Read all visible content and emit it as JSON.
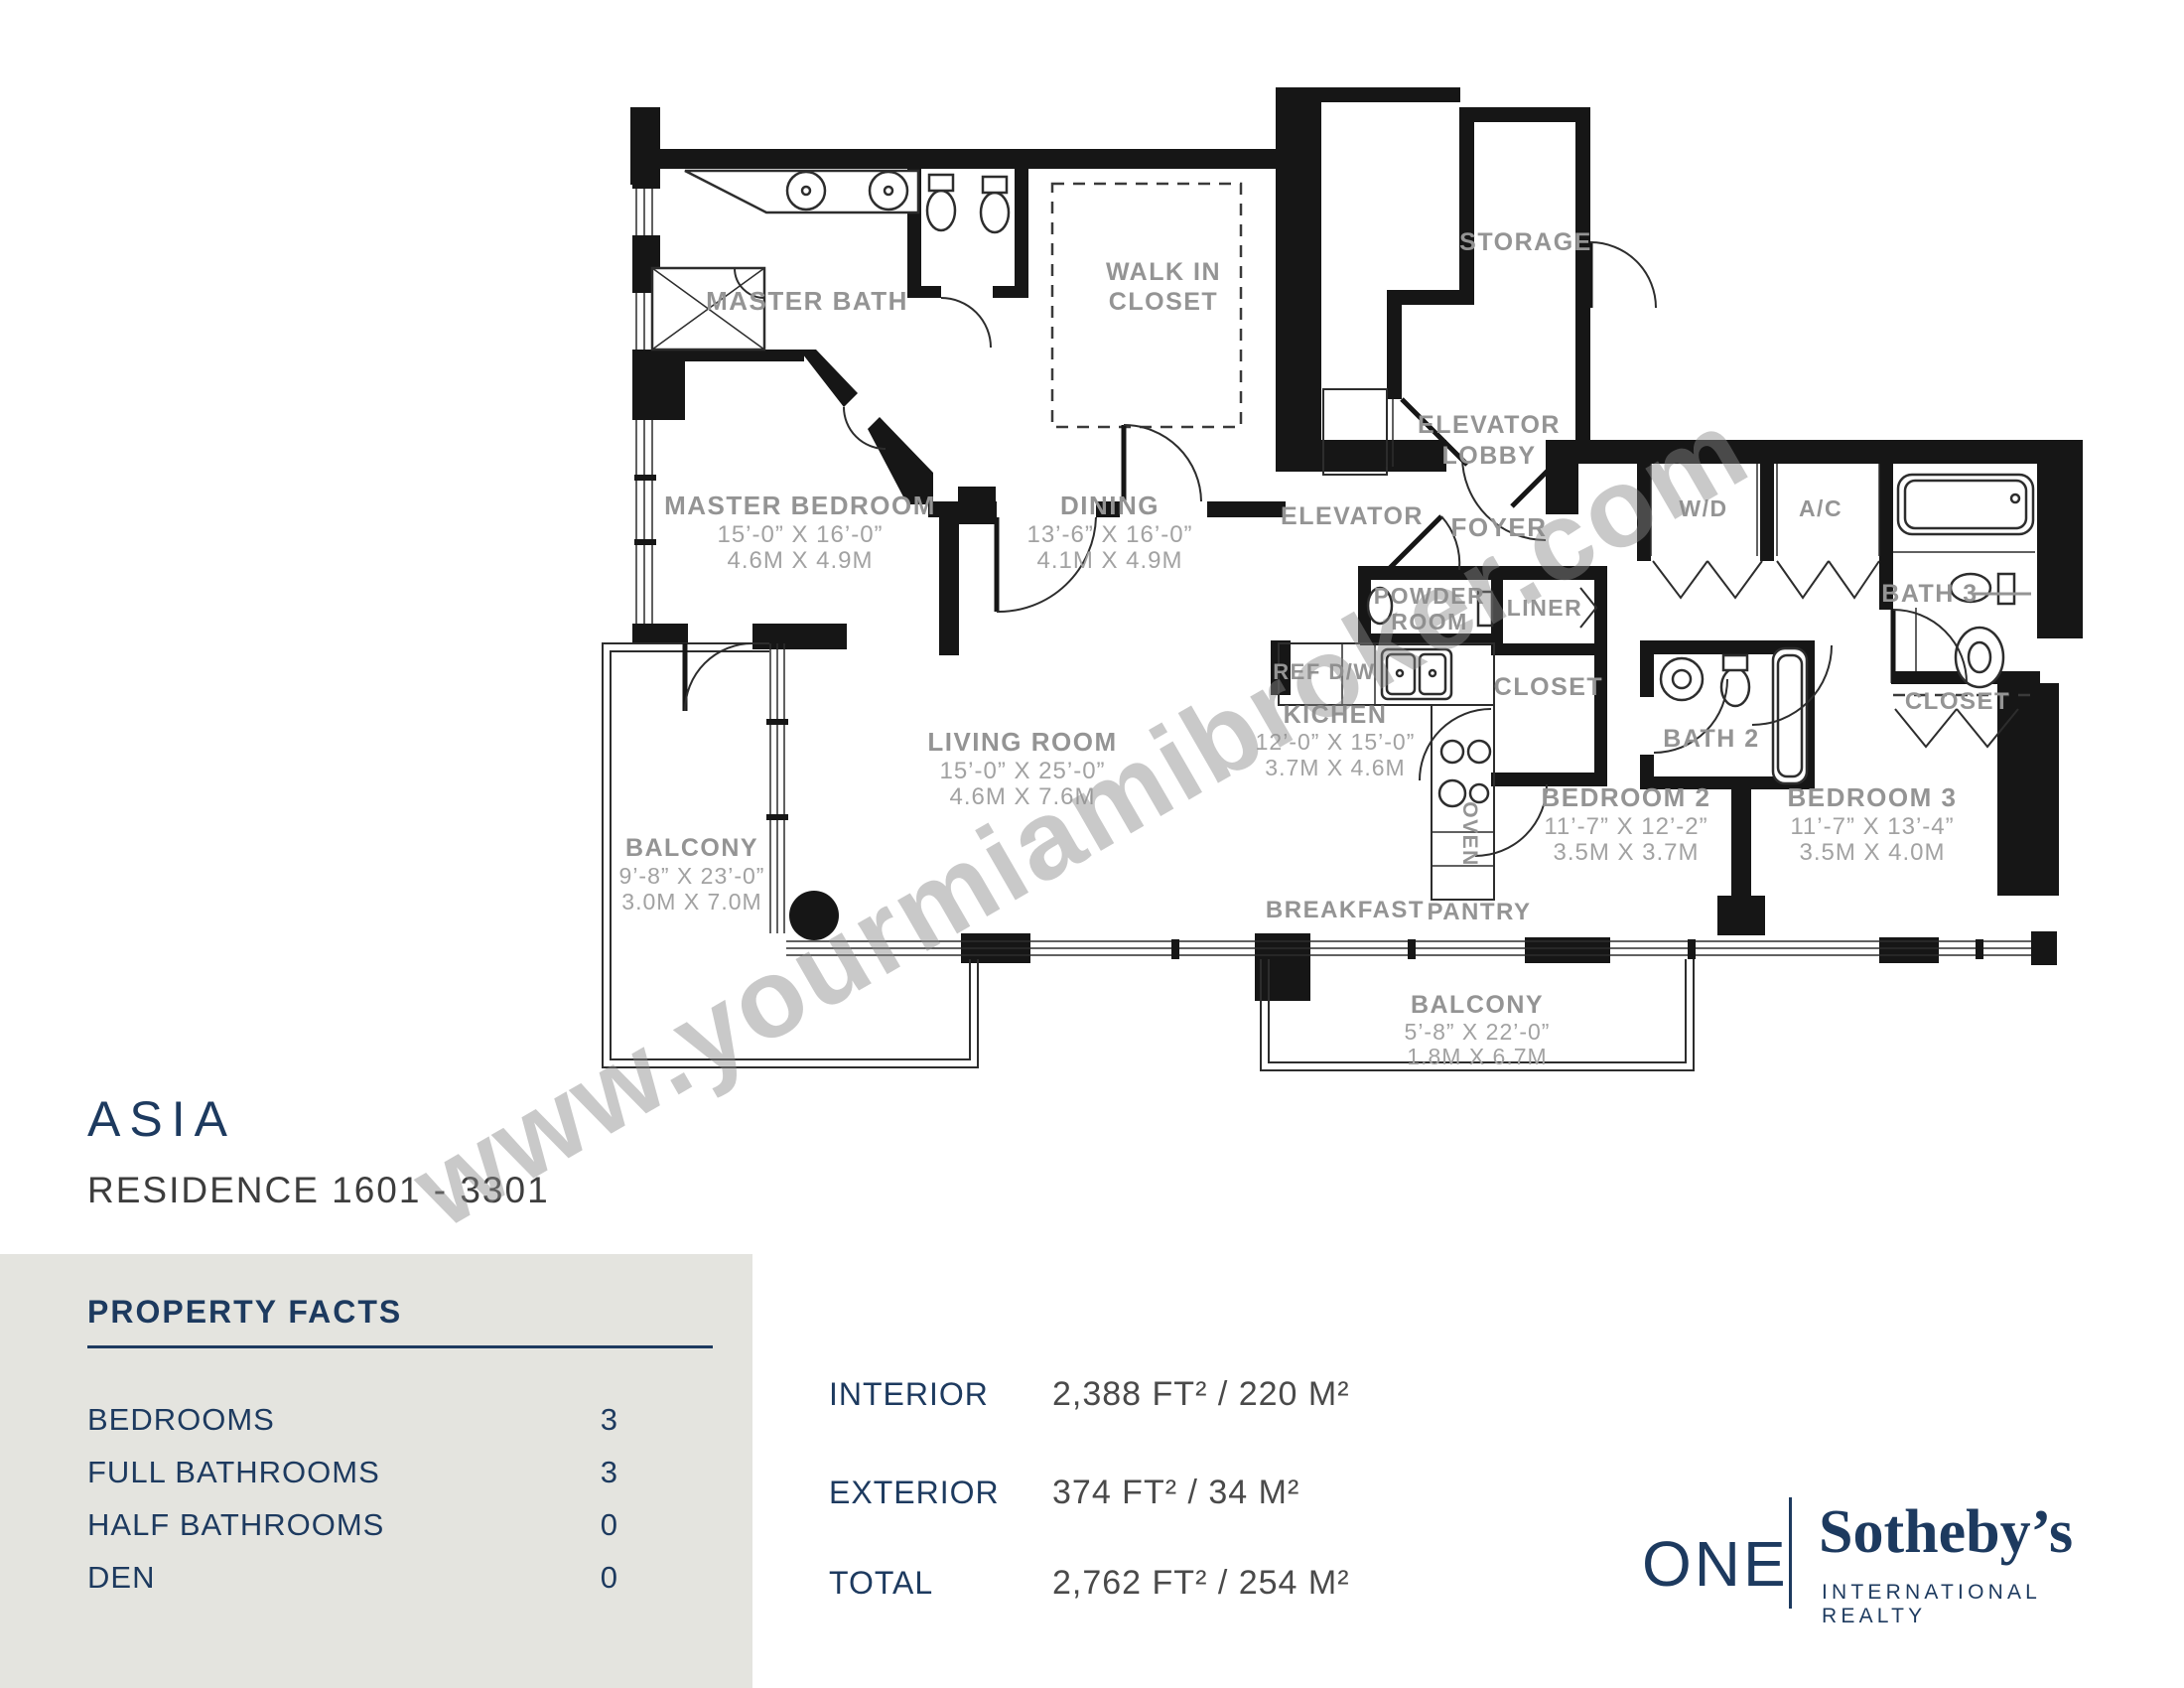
{
  "colors": {
    "accent_navy": "#1d3a5f",
    "wall_black": "#161616",
    "room_label_gray": "#949494",
    "panel_bg": "#e4e4df"
  },
  "watermark": "www.yourmiamibroker.com",
  "title": {
    "building": "ASIA",
    "residence": "RESIDENCE 1601 - 3301"
  },
  "property_facts": {
    "heading": "PROPERTY FACTS",
    "rows": [
      {
        "label": "BEDROOMS",
        "value": "3"
      },
      {
        "label": "FULL BATHROOMS",
        "value": "3"
      },
      {
        "label": "HALF BATHROOMS",
        "value": "0"
      },
      {
        "label": "DEN",
        "value": "0"
      }
    ]
  },
  "areas": [
    {
      "label": "INTERIOR",
      "value": "2,388 FT²  / 220 M²"
    },
    {
      "label": "EXTERIOR",
      "value": "374 FT²  / 34 M²"
    },
    {
      "label": "TOTAL",
      "value": "2,762 FT²  / 254 M²"
    }
  ],
  "logo": {
    "one": "ONE",
    "brand": "Sotheby’s",
    "sub": "INTERNATIONAL REALTY"
  },
  "plan": {
    "master_bath": {
      "name": "MASTER BATH"
    },
    "walk_in_closet": {
      "l1": "WALK IN",
      "l2": "CLOSET"
    },
    "storage": {
      "name": "STORAGE"
    },
    "elevator_lobby": {
      "l1": "ELEVATOR",
      "l2": "LOBBY"
    },
    "elevator": {
      "name": "ELEVATOR"
    },
    "foyer": {
      "name": "FOYER"
    },
    "master_bedroom": {
      "name": "MASTER BEDROOM",
      "ft": "15’-0” X 16’-0”",
      "m": "4.6M X 4.9M"
    },
    "dining": {
      "name": "DINING",
      "ft": "13’-6” X 16’-0”",
      "m": "4.1M X 4.9M"
    },
    "powder_room": {
      "l1": "POWDER",
      "l2": "ROOM"
    },
    "liner": {
      "name": "LINER"
    },
    "wd": {
      "name": "W/D"
    },
    "ac": {
      "name": "A/C"
    },
    "bath3": {
      "name": "BATH 3"
    },
    "closet_hall": {
      "name": "CLOSET"
    },
    "bath2": {
      "name": "BATH 2"
    },
    "closet_bed3": {
      "name": "CLOSET"
    },
    "ref_dw": {
      "name": "REF D/W"
    },
    "kitchen": {
      "name": "KICHEN",
      "ft": "12’-0” X 15’-0”",
      "m": "3.7M X 4.6M"
    },
    "oven": {
      "name": "OVEN"
    },
    "living_room": {
      "name": "LIVING ROOM",
      "ft": "15’-0” X 25’-0”",
      "m": "4.6M X 7.6M"
    },
    "balcony_left": {
      "name": "BALCONY",
      "ft": "9’-8” X 23’-0”",
      "m": "3.0M X 7.0M"
    },
    "bedroom2": {
      "name": "BEDROOM 2",
      "ft": "11’-7” X 12’-2”",
      "m": "3.5M X 3.7M"
    },
    "bedroom3": {
      "name": "BEDROOM 3",
      "ft": "11’-7” X 13’-4”",
      "m": "3.5M X 4.0M"
    },
    "breakfast": {
      "name": "BREAKFAST"
    },
    "pantry": {
      "name": "PANTRY"
    },
    "balcony_bottom": {
      "name": "BALCONY",
      "ft": "5’-8” X 22’-0”",
      "m": "1.8M X 6.7M"
    }
  }
}
